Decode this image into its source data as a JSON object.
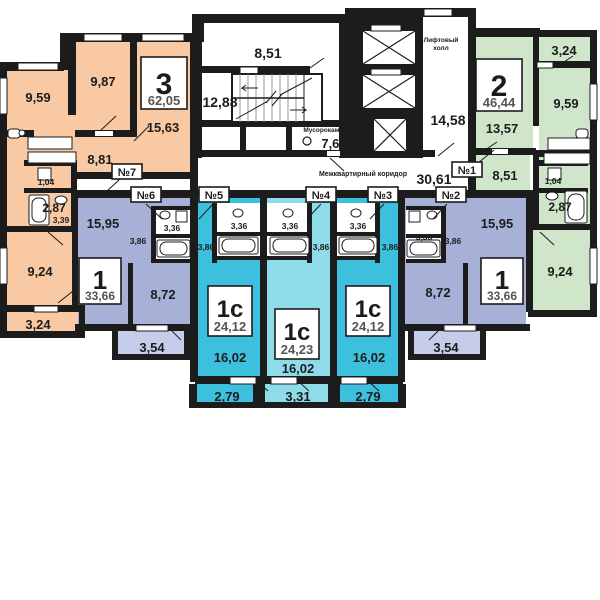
{
  "common": {
    "upper_hall": "8,51",
    "stairs": "12,88",
    "trash_label": "Мусорокамера",
    "trash": "7,63",
    "lift_label1": "Лифтовый",
    "lift_label2": "холл",
    "lift_hall": "14,58",
    "corridor_label": "Межквартирный коридор",
    "corridor": "30,61"
  },
  "apts": {
    "a7": {
      "door": "№7",
      "type": "3",
      "total": "62,05",
      "r1": "9,59",
      "r2": "9,87",
      "r3": "15,63",
      "hall": "8,81",
      "wc": "1,04",
      "bath": "2,87",
      "hall2": "3,39",
      "r4": "9,24",
      "balcony": "3,24"
    },
    "a6": {
      "door": "№6",
      "type": "1",
      "total": "33,66",
      "r1": "15,95",
      "hall": "3,86",
      "bath": "3,36",
      "r2": "8,72",
      "balcony": "3,54"
    },
    "a5": {
      "door": "№5",
      "type": "1с",
      "total": "24,12",
      "bath": "3,36",
      "hall": "3,86",
      "r1": "16,02",
      "balcony": "2,79"
    },
    "a4": {
      "door": "№4",
      "type": "1с",
      "total": "24,23",
      "bath": "3,36",
      "hall": "3,86",
      "r1": "16,02",
      "balcony": "3,31"
    },
    "a3": {
      "door": "№3",
      "type": "1с",
      "total": "24,12",
      "bath": "3,36",
      "hall": "3,86",
      "r1": "16,02",
      "balcony": "2,79"
    },
    "a2": {
      "door": "№2",
      "type": "1",
      "total": "33,66",
      "r1": "15,95",
      "hall": "3,86",
      "bath": "3,36",
      "r2": "8,72",
      "balcony": "3,54"
    },
    "a1": {
      "door": "№1",
      "type": "2",
      "total": "46,44",
      "r1": "13,57",
      "r2": "9,59",
      "r3": "9,24",
      "hall": "8,51",
      "wc": "1,04",
      "bath": "2,87",
      "balcony": "3,24"
    }
  },
  "colors": {
    "wall": "#1c1c1c",
    "orange": "#f8c9a2",
    "green": "#cfe6ca",
    "cyan": "#3cc0dd",
    "cyan_light": "#8edbea",
    "purple": "#a7b1d8",
    "purple_light": "#c6cdea"
  }
}
